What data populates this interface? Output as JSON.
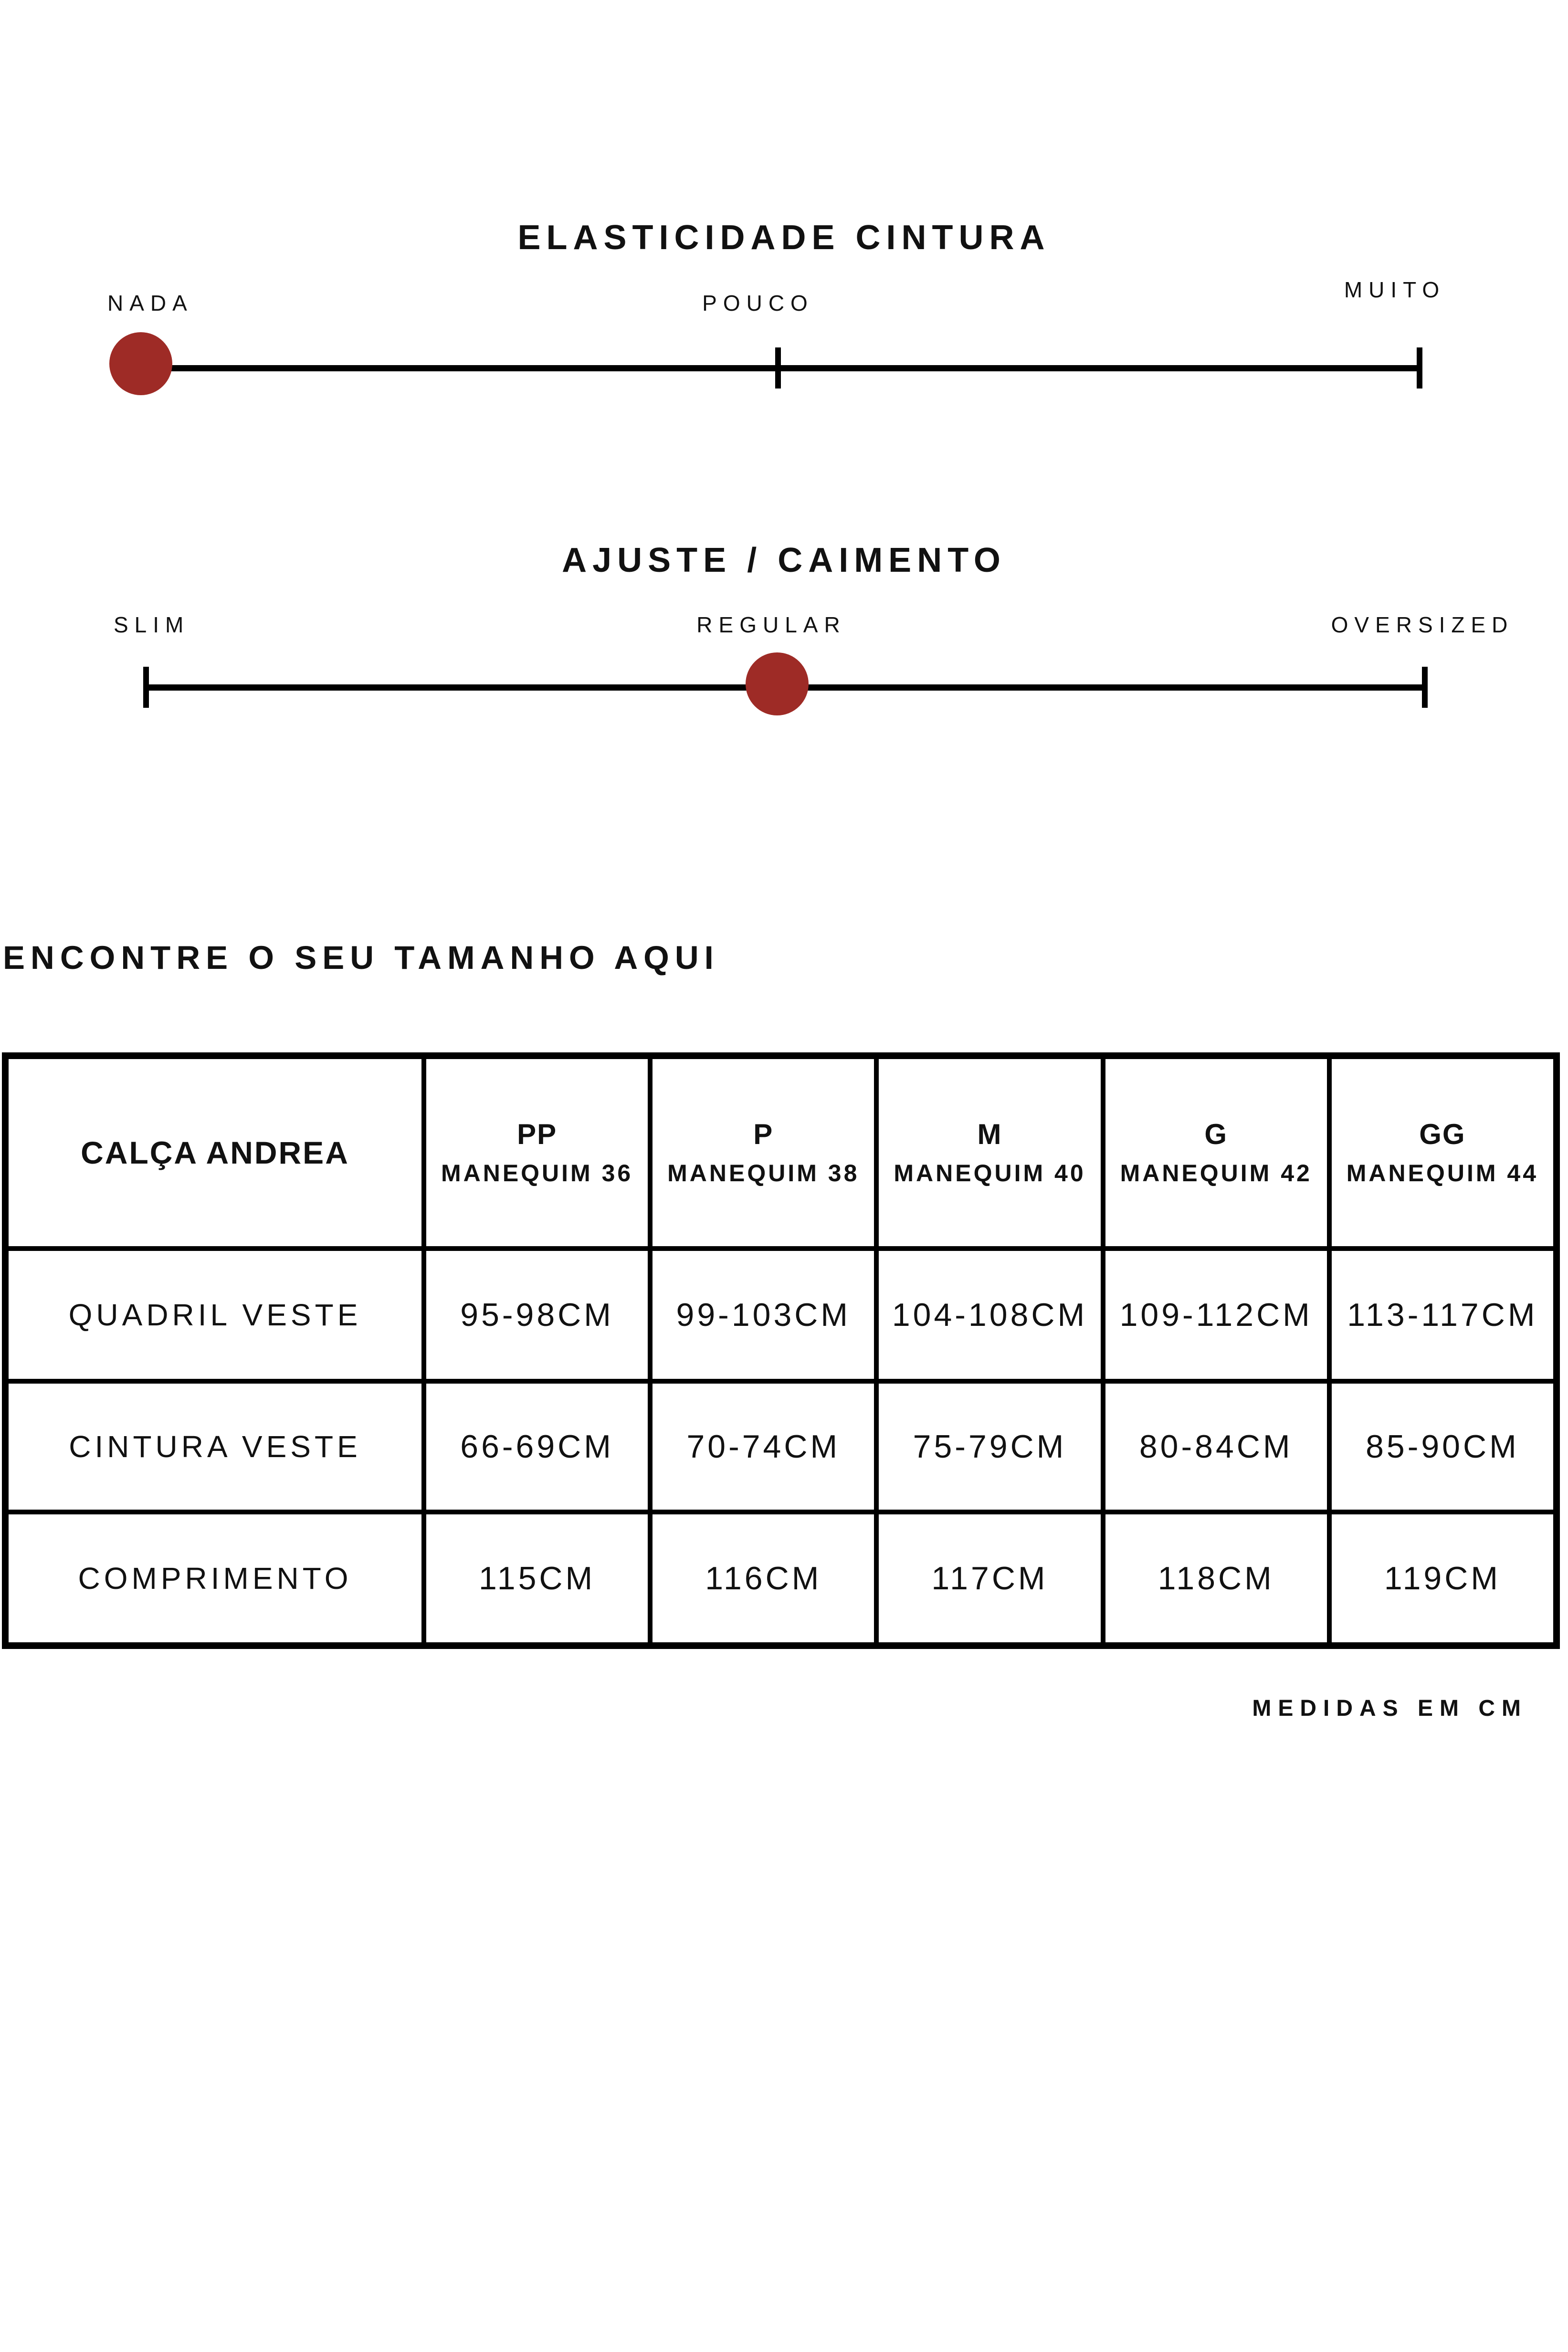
{
  "sliders": [
    {
      "title": "ELASTICIDADE CINTURA",
      "labels": [
        "NADA",
        "POUCO",
        "MUITO"
      ],
      "selected": "NADA"
    },
    {
      "title": "AJUSTE / CAIMENTO",
      "labels": [
        "SLIM",
        "REGULAR",
        "OVERSIZED"
      ],
      "selected": "REGULAR"
    }
  ],
  "size_guide": {
    "heading": "ENCONTRE O SEU TAMANHO AQUI",
    "product": "CALÇA ANDREA",
    "columns": [
      {
        "size": "PP",
        "mannequin": "MANEQUIM 36"
      },
      {
        "size": "P",
        "mannequin": "MANEQUIM 38"
      },
      {
        "size": "M",
        "mannequin": "MANEQUIM 40"
      },
      {
        "size": "G",
        "mannequin": "MANEQUIM 42"
      },
      {
        "size": "GG",
        "mannequin": "MANEQUIM 44"
      }
    ],
    "rows": [
      {
        "label": "QUADRIL VESTE",
        "values": [
          "95-98CM",
          "99-103CM",
          "104-108CM",
          "109-112CM",
          "113-117CM"
        ]
      },
      {
        "label": "CINTURA VESTE",
        "values": [
          "66-69CM",
          "70-74CM",
          "75-79CM",
          "80-84CM",
          "85-90CM"
        ]
      },
      {
        "label": "COMPRIMENTO",
        "values": [
          "115CM",
          "116CM",
          "117CM",
          "118CM",
          "119CM"
        ]
      }
    ],
    "footnote": "MEDIDAS EM CM"
  },
  "colors": {
    "accent_red": "#9e2b26",
    "line_black": "#000000",
    "text": "#111111"
  }
}
